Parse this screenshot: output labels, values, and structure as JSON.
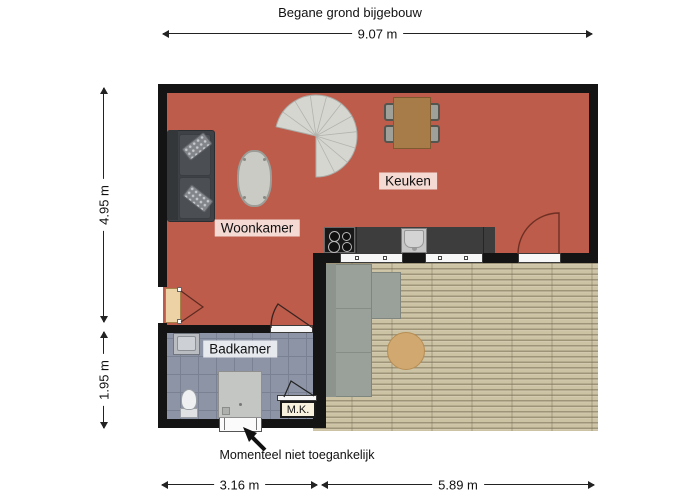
{
  "title": "Begane grond bijgebouw",
  "dimensions": {
    "width_total": "9.07 m",
    "height_upper": "4.95 m",
    "height_lower": "1.95 m",
    "width_bottom_left": "3.16 m",
    "width_bottom_right": "5.89 m"
  },
  "rooms": {
    "living": "Woonkamer",
    "kitchen": "Keuken",
    "bathroom": "Badkamer",
    "meter_closet": "M.K."
  },
  "annotation": {
    "note": "Momenteel niet toegankelijk"
  },
  "colors": {
    "floor_red": "#bd5c4b",
    "deck_tan": "#ccc2a4",
    "bathroom_tile": "#8d94a5",
    "wall": "#141414",
    "door_arc": "#6e2f23"
  }
}
